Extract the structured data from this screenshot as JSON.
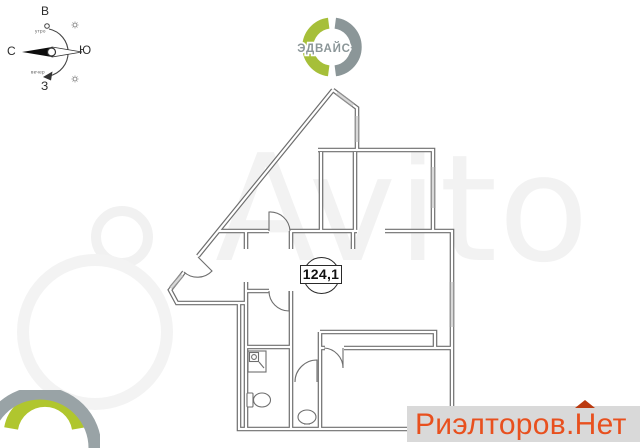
{
  "compass": {
    "east": "В",
    "south": "Ю",
    "west": "З",
    "north": "С",
    "morning": "утро",
    "evening": "вечер"
  },
  "developer_logo": {
    "name": "ЭДВАЙС",
    "green": "#a6bf39",
    "gray": "#8b9698"
  },
  "plan": {
    "area_label": "124,1",
    "wall_color": "#6e6e6e",
    "window_color": "#d9d9d9"
  },
  "watermark": {
    "site": "Avito",
    "color": "#f2f2f2"
  },
  "realtor": {
    "prefix": "Риэлторов.",
    "suffix": "Нет",
    "text_color": "#e8501e",
    "bg_color": "#d9d9d9",
    "roof_color": "#bb3a10"
  },
  "corner_logo": {
    "green": "#b0c62e",
    "gray": "#99a3a6"
  }
}
